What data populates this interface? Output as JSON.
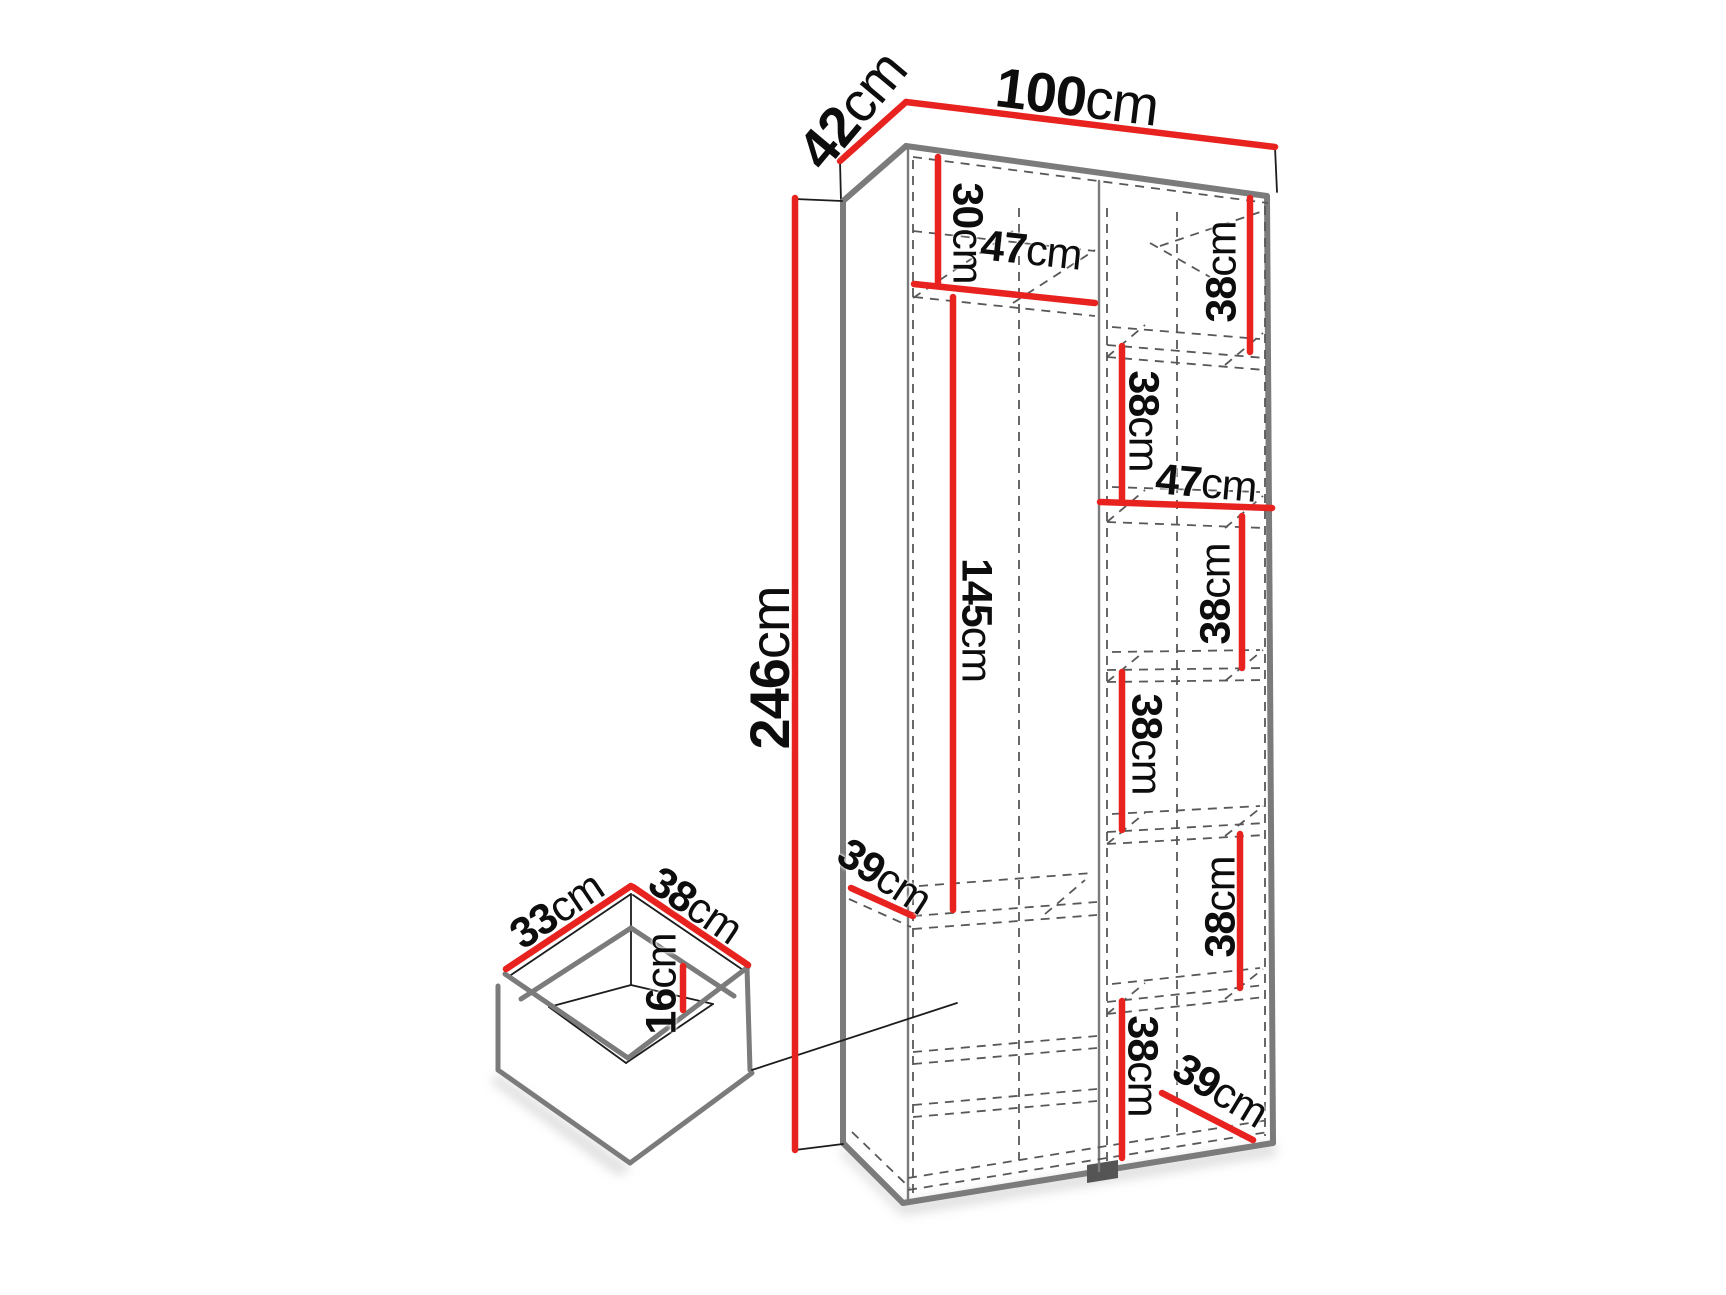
{
  "diagram": {
    "type": "furniture-dimension-diagram",
    "subject": "tall wardrobe cabinet with shelves and separate drawer detail",
    "unit": "cm",
    "accent_color": "#e8231f",
    "line_color": "#1c1c1c",
    "edge_color": "#7b7b7b",
    "dimensions_summary": {
      "overall": {
        "width_cm": 100,
        "depth_cm": 42,
        "height_cm": 246
      },
      "left_column": {
        "top_gap_cm": 30,
        "width_cm": 47,
        "hanging_height_cm": 145,
        "shelf_depth_cm": 39
      },
      "right_column": {
        "width_cm": 47,
        "shelf_spacing_cm": [
          38,
          38,
          38,
          38,
          38,
          38
        ],
        "bottom_shelf_depth_cm": 39
      },
      "drawer": {
        "depth_cm": 33,
        "width_cm": 38,
        "height_cm": 16
      }
    },
    "labels": [
      {
        "id": "depth-42",
        "value": "42",
        "unit": "cm",
        "x": 852,
        "y": 110,
        "rot": -50,
        "size": "big"
      },
      {
        "id": "width-100",
        "value": "100",
        "unit": "cm",
        "x": 1077,
        "y": 97,
        "rot": 7,
        "size": "big"
      },
      {
        "id": "top-gap-30",
        "value": "30",
        "unit": "cm",
        "x": 967,
        "y": 233,
        "rot": 90,
        "size": "small"
      },
      {
        "id": "left-width-47",
        "value": "47",
        "unit": "cm",
        "x": 1031,
        "y": 251,
        "rot": 6,
        "size": "small"
      },
      {
        "id": "right-shelf-38-1",
        "value": "38",
        "unit": "cm",
        "x": 1222,
        "y": 272,
        "rot": -90,
        "size": "small"
      },
      {
        "id": "right-shelf-38-2",
        "value": "38",
        "unit": "cm",
        "x": 1143,
        "y": 421,
        "rot": 90,
        "size": "small"
      },
      {
        "id": "right-width-47",
        "value": "47",
        "unit": "cm",
        "x": 1206,
        "y": 484,
        "rot": 5,
        "size": "small"
      },
      {
        "id": "right-shelf-38-3",
        "value": "38",
        "unit": "cm",
        "x": 1216,
        "y": 594,
        "rot": -90,
        "size": "small"
      },
      {
        "id": "right-shelf-38-4",
        "value": "38",
        "unit": "cm",
        "x": 1146,
        "y": 744,
        "rot": 90,
        "size": "small"
      },
      {
        "id": "right-shelf-38-5",
        "value": "38",
        "unit": "cm",
        "x": 1221,
        "y": 907,
        "rot": -90,
        "size": "small"
      },
      {
        "id": "right-shelf-38-6",
        "value": "38",
        "unit": "cm",
        "x": 1142,
        "y": 1066,
        "rot": 90,
        "size": "small"
      },
      {
        "id": "bottom-depth-39",
        "value": "39",
        "unit": "cm",
        "x": 1220,
        "y": 1091,
        "rot": 31,
        "size": "small"
      },
      {
        "id": "left-shelf-depth-39",
        "value": "39",
        "unit": "cm",
        "x": 884,
        "y": 877,
        "rot": 33,
        "size": "small"
      },
      {
        "id": "height-246",
        "value": "246",
        "unit": "cm",
        "x": 770,
        "y": 668,
        "rot": -90,
        "size": "big"
      },
      {
        "id": "hanging-145",
        "value": "145",
        "unit": "cm",
        "x": 976,
        "y": 620,
        "rot": 90,
        "size": "small"
      },
      {
        "id": "drawer-depth-33",
        "value": "33",
        "unit": "cm",
        "x": 557,
        "y": 911,
        "rot": -34,
        "size": "small"
      },
      {
        "id": "drawer-width-38",
        "value": "38",
        "unit": "cm",
        "x": 695,
        "y": 906,
        "rot": 34,
        "size": "small"
      },
      {
        "id": "drawer-height-16",
        "value": "16",
        "unit": "cm",
        "x": 662,
        "y": 984,
        "rot": -90,
        "size": "small"
      }
    ]
  }
}
